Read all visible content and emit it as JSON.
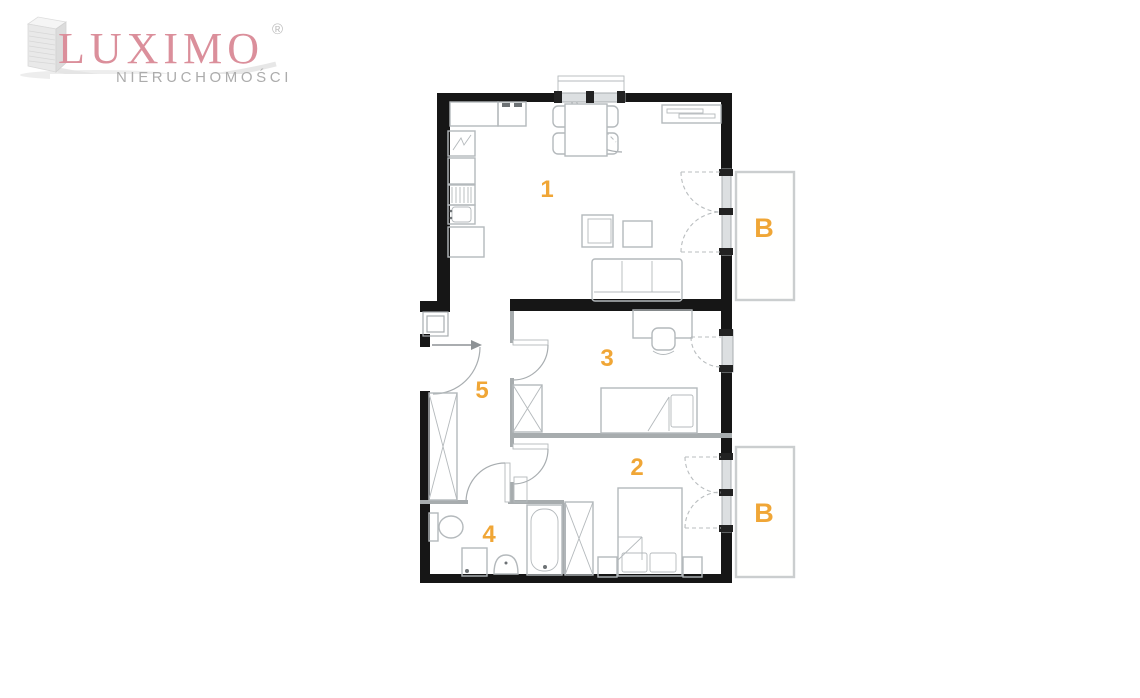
{
  "brand": {
    "name": "LUXIMO",
    "registered_mark": "®",
    "subtitle": "NIERUCHOMOŚCI"
  },
  "floorplan": {
    "room_labels": [
      "1",
      "2",
      "3",
      "4",
      "5"
    ],
    "balcony_labels": [
      "B",
      "B"
    ]
  },
  "colors": {
    "accent": "#F0A636",
    "wall": "#161616",
    "partition": "#a7acae",
    "furniture": "#b4b9bc",
    "door": "#a8adb0",
    "dashline": "#b9bdbf",
    "window_fill": "#dcdfe1",
    "cap": "#222222",
    "balcony_border": "#cbcecf",
    "logo_pink": "#DB8F9B",
    "logo_gray": "#ACACAC"
  }
}
